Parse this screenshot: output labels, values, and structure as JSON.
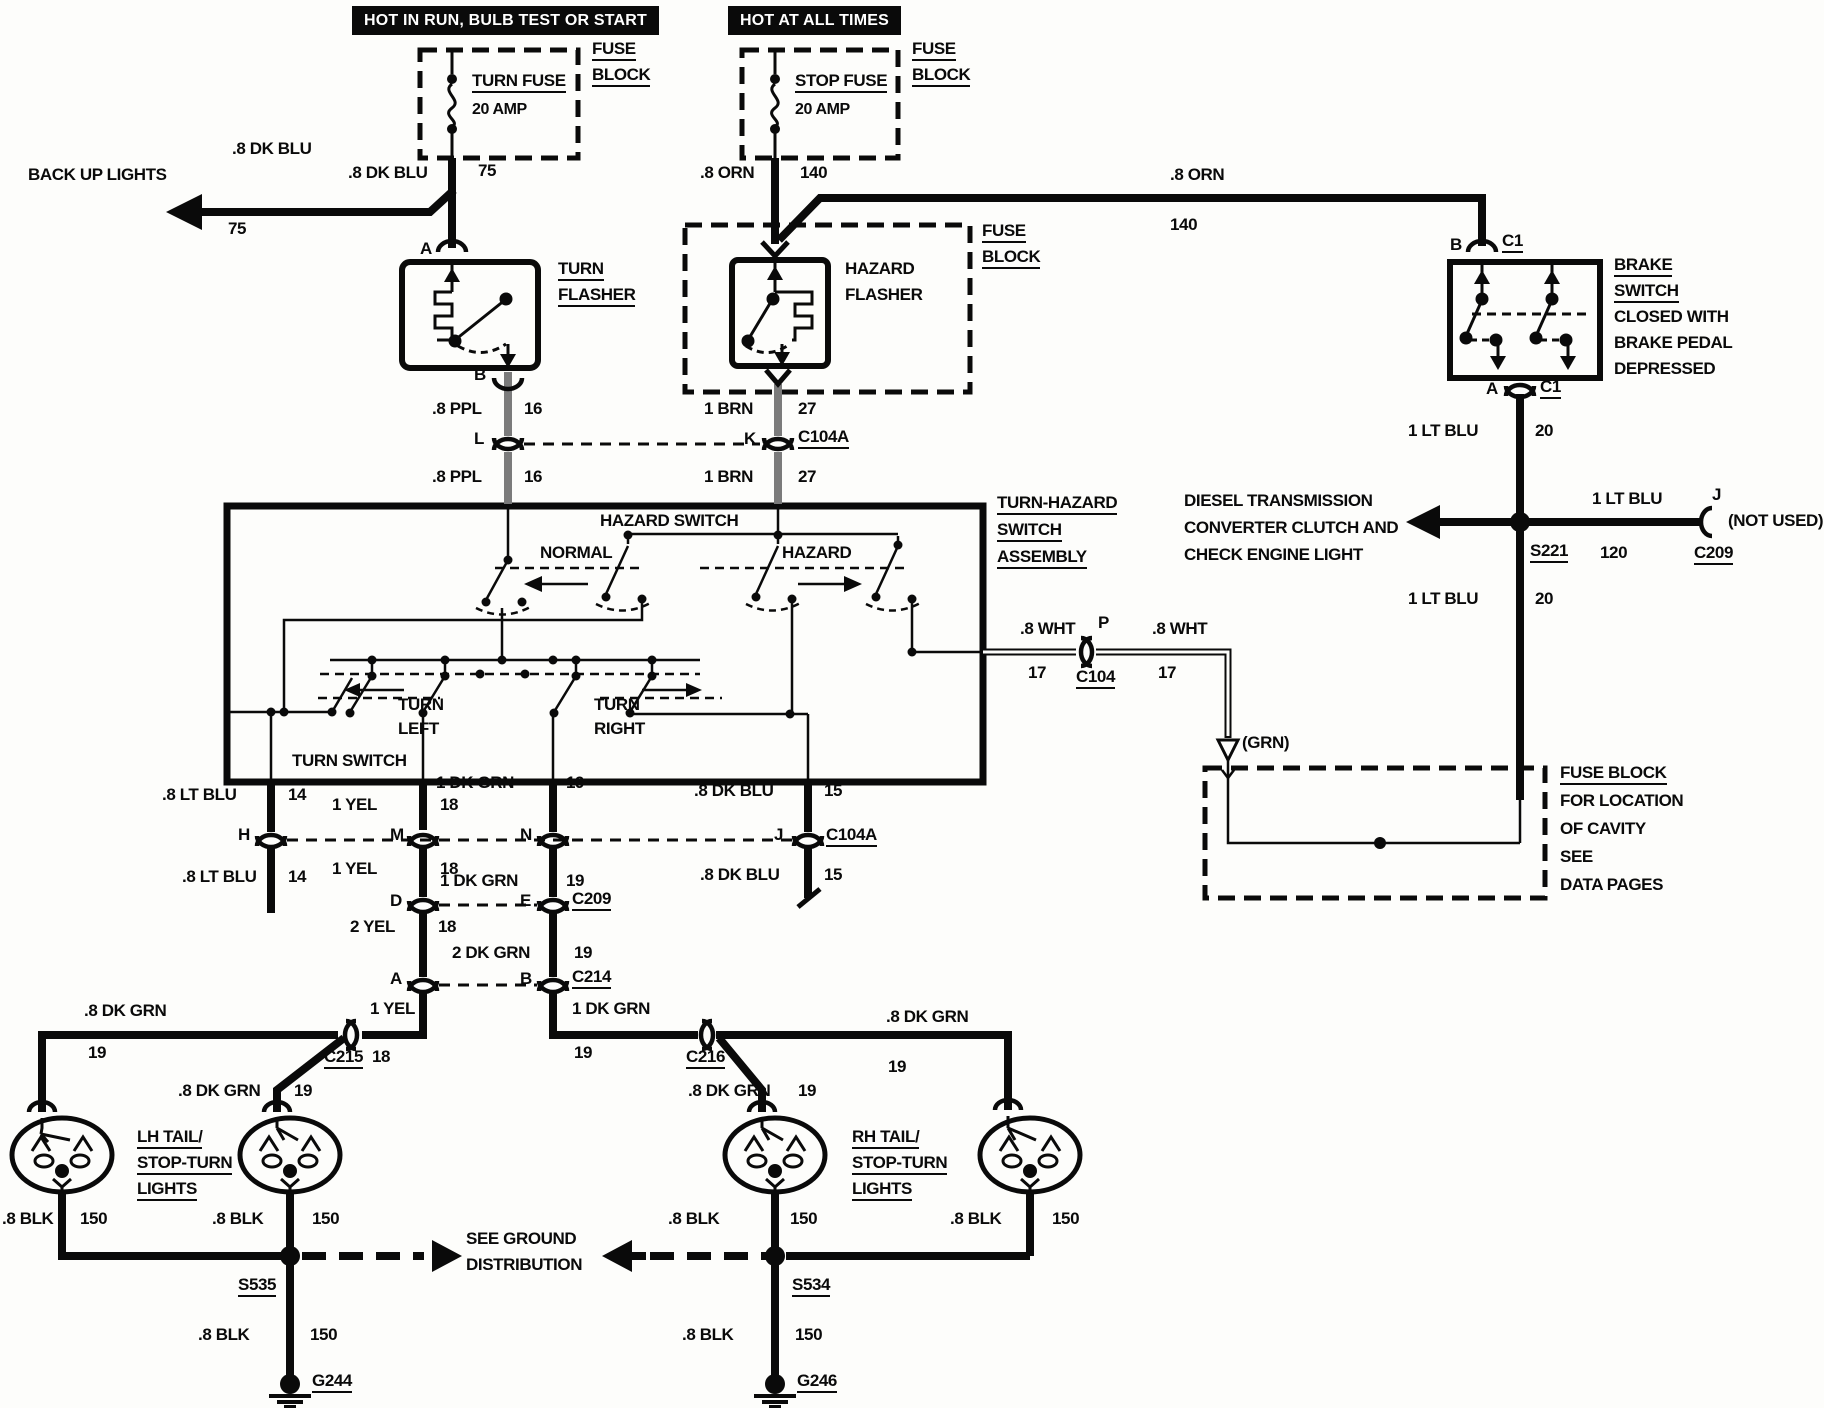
{
  "banners": {
    "run": "HOT IN RUN, BULB TEST OR START",
    "all_times": "HOT AT ALL TIMES"
  },
  "fuse_block_label": {
    "l1": "FUSE",
    "l2": "BLOCK"
  },
  "fuses": {
    "turn": {
      "name": "TURN FUSE",
      "rating": "20 AMP"
    },
    "stop": {
      "name": "STOP FUSE",
      "rating": "20 AMP"
    }
  },
  "back_up_lights": "BACK UP LIGHTS",
  "flashers": {
    "turn": {
      "l1": "TURN",
      "l2": "FLASHER"
    },
    "hazard": {
      "l1": "HAZARD",
      "l2": "FLASHER"
    }
  },
  "brake_switch": {
    "l1": "BRAKE",
    "l2": "SWITCH",
    "l3": "CLOSED WITH",
    "l4": "BRAKE PEDAL",
    "l5": "DEPRESSED"
  },
  "assembly": {
    "name1": "TURN-HAZARD",
    "name2": "SWITCH",
    "name3": "ASSEMBLY",
    "hazard_switch": "HAZARD SWITCH",
    "normal": "NORMAL",
    "hazard": "HAZARD",
    "turn": "TURN",
    "left": "LEFT",
    "right": "RIGHT",
    "turn_switch": "TURN SWITCH"
  },
  "diesel": {
    "l1": "DIESEL TRANSMISSION",
    "l2": "CONVERTER CLUTCH AND",
    "l3": "CHECK ENGINE LIGHT"
  },
  "fuse_block_cavity": {
    "l1": "FUSE BLOCK",
    "l2": "FOR LOCATION",
    "l3": "OF CAVITY",
    "l4": "SEE",
    "l5": "DATA PAGES"
  },
  "not_used": "(NOT USED)",
  "grn": "(GRN)",
  "tail_lh": {
    "l1": "LH TAIL/",
    "l2": "STOP-TURN",
    "l3": "LIGHTS"
  },
  "tail_rh": {
    "l1": "RH TAIL/",
    "l2": "STOP-TURN",
    "l3": "LIGHTS"
  },
  "see_ground": {
    "l1": "SEE GROUND",
    "l2": "DISTRIBUTION"
  },
  "wires": {
    "dk_blu": ".8 DK BLU",
    "orn": ".8 ORN",
    "ppl": ".8 PPL",
    "brn": "1 BRN",
    "lt_blu_1": "1 LT BLU",
    "wht": ".8 WHT",
    "lt_blu_8": ".8 LT BLU",
    "yel_1": "1 YEL",
    "dk_grn_1": "1 DK GRN",
    "yel_2": "2 YEL",
    "dk_grn_2": "2 DK GRN",
    "dk_grn_8": ".8 DK GRN",
    "blk": ".8 BLK"
  },
  "circuits": {
    "c75": "75",
    "c140": "140",
    "c16": "16",
    "c27": "27",
    "c20": "20",
    "c17": "17",
    "c120": "120",
    "c14": "14",
    "c18": "18",
    "c19": "19",
    "c15": "15",
    "c150": "150"
  },
  "connectors": {
    "c1": "C1",
    "c104a": "C104A",
    "c104": "C104",
    "c209": "C209",
    "c214": "C214",
    "c215": "C215",
    "c216": "C216",
    "s221": "S221",
    "s535": "S535",
    "s534": "S534",
    "g244": "G244",
    "g246": "G246"
  },
  "terminals": {
    "a": "A",
    "b": "B",
    "d": "D",
    "e": "E",
    "h": "H",
    "j": "J",
    "k": "K",
    "l": "L",
    "m": "M",
    "n": "N",
    "p": "P"
  }
}
